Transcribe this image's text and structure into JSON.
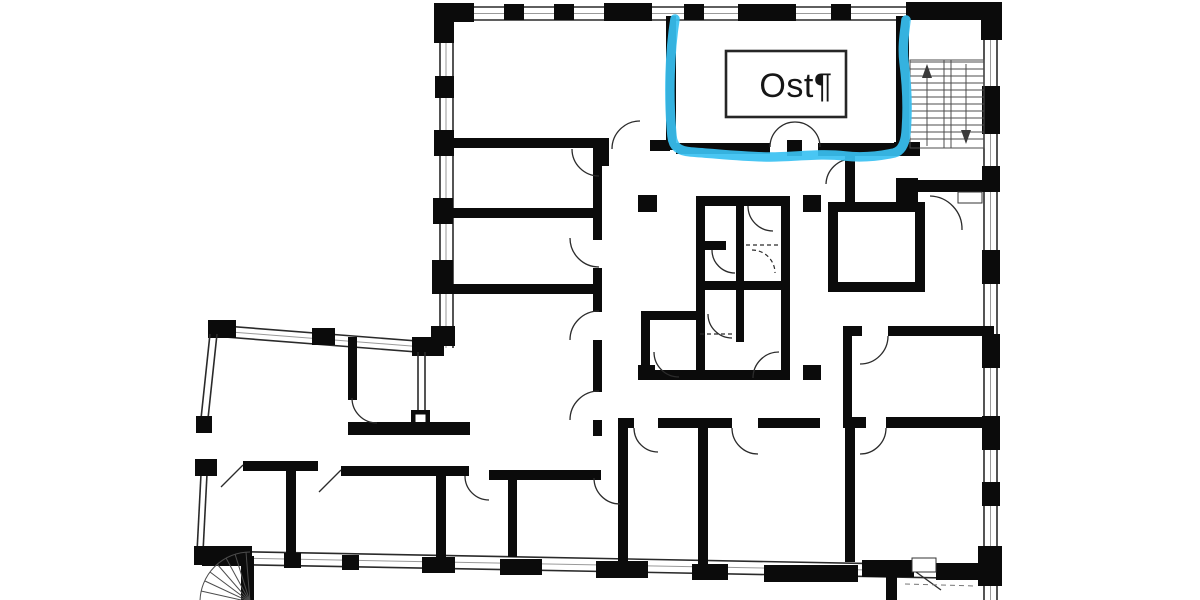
{
  "meta": {
    "description": "Scanned architectural floor plan with a hand-drawn highlight marking the east room and a text-box label",
    "background": "#ffffff"
  },
  "floor_plan": {
    "wall_color": "#0b0b0b",
    "line_color": "#2a2a2a"
  },
  "annotation": {
    "room_label": "Ost¶",
    "highlight_color": "#3ac1f2",
    "label_text_color": "#161616",
    "label_box_border": "#262626"
  }
}
